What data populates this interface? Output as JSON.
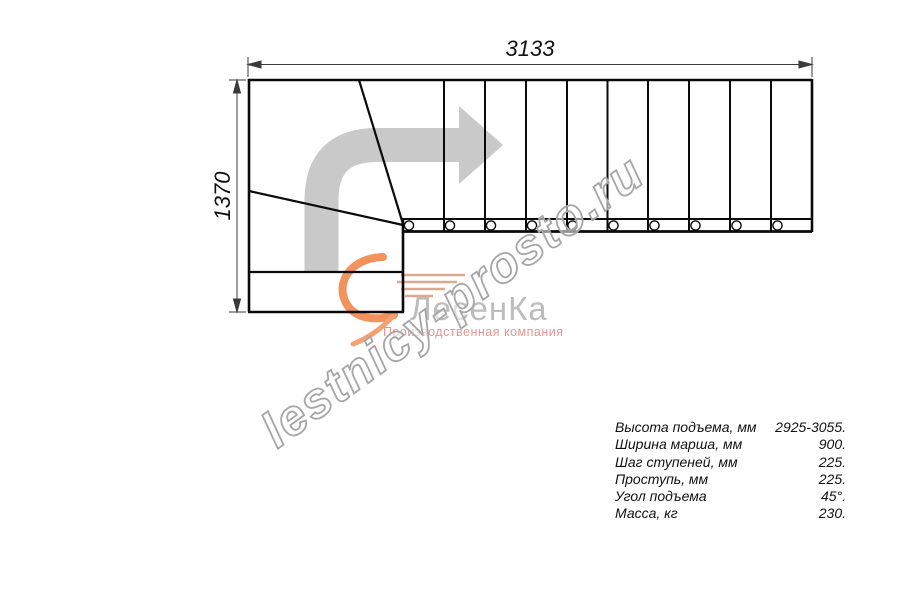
{
  "drawing": {
    "title": "L-shaped staircase plan (top view)",
    "width_label": "3133",
    "height_label": "1370",
    "straight_steps_count": 10,
    "baluster_count": 10,
    "line_color": "#0a0a0a",
    "dimension_color": "#3a3a3a"
  },
  "direction_arrow": {
    "color": "#c9c9c9"
  },
  "watermark": {
    "text": "lestnicy-prosto.ru",
    "stroke_color": "#a6a6a6"
  },
  "logo": {
    "wordmark": "ЛесенКа",
    "tagline": "Производственная компания",
    "accent_color": "#f2925c",
    "wordmark_color": "#bdbdbd",
    "tagline_color": "#e59595"
  },
  "specs": {
    "rows": [
      {
        "label": "Высота подъема, мм",
        "value": "2925-3055."
      },
      {
        "label": "Ширина марша, мм",
        "value": "900."
      },
      {
        "label": "Шаг ступеней, мм",
        "value": "225."
      },
      {
        "label": "Проступь, мм",
        "value": "225."
      },
      {
        "label": "Угол подъема",
        "value": "45°."
      },
      {
        "label": "Масса, кг",
        "value": "230."
      }
    ]
  }
}
